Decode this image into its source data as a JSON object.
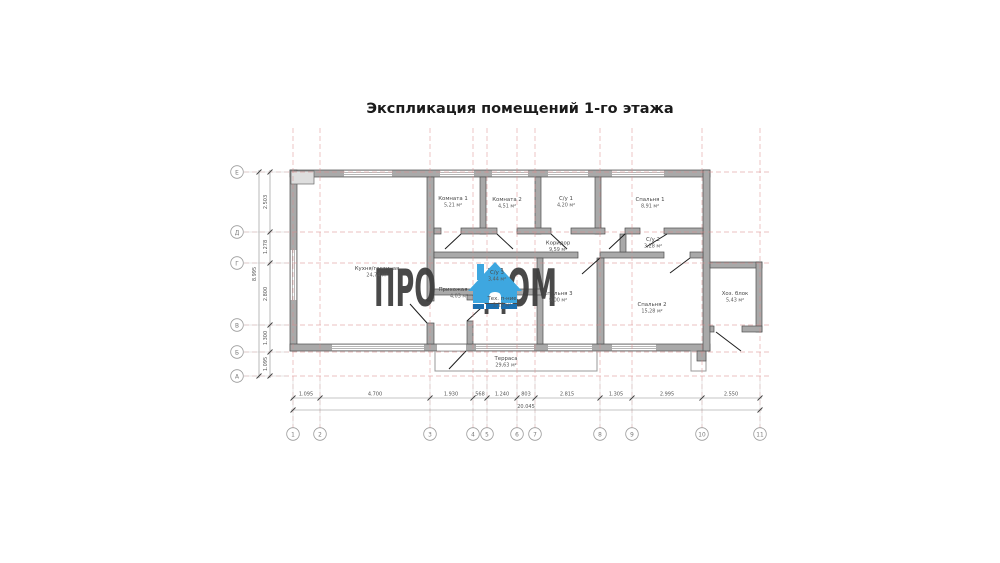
{
  "title": "Экспликация помещений 1-го этажа",
  "watermark": {
    "text_left": "ПРО",
    "text_right": "ДОМ",
    "icon": "house-icon",
    "colors": {
      "text": "#3c3c3c",
      "house_blue": "#3ea7e0",
      "house_dark_blue": "#1b6fb0"
    }
  },
  "colors": {
    "wall_fill": "#a9a9a9",
    "wall_stroke": "#4f4f4f",
    "grid_red": "#d98c8c",
    "dim_gray": "#8a8a8a",
    "label_gray": "#474747"
  },
  "rooms": [
    {
      "name": "Кухня/гостиная",
      "area": "24,74 м²"
    },
    {
      "name": "Комната 1",
      "area": "5,21 м²"
    },
    {
      "name": "Комната 2",
      "area": "4,51 м²"
    },
    {
      "name": "С/у 1",
      "area": "4,20 м²"
    },
    {
      "name": "Спальня 1",
      "area": "8,91 м²"
    },
    {
      "name": "Коридор",
      "area": "9,59 м²"
    },
    {
      "name": "С/у 2",
      "area": "3,28 м²"
    },
    {
      "name": "С/у 3",
      "area": "3,44 м²"
    },
    {
      "name": "Прихожая",
      "area": "4,03 м²"
    },
    {
      "name": "Тех. п-ние",
      "area": "2,18 м²"
    },
    {
      "name": "Спальня 3",
      "area": "9,00 м²"
    },
    {
      "name": "Спальня 2",
      "area": "15,28 м²"
    },
    {
      "name": "Хоз. блок",
      "area": "5,43 м²"
    },
    {
      "name": "Терраса",
      "area": "29,63 м²"
    }
  ],
  "axes": {
    "columns": [
      "1",
      "2",
      "3",
      "4",
      "5",
      "6",
      "7",
      "8",
      "9",
      "10",
      "11"
    ],
    "rows": [
      "Е",
      "Д",
      "Г",
      "В",
      "Б",
      "А"
    ]
  },
  "dimensions": {
    "bottom": [
      "1.095",
      "4.700",
      "1.930",
      "568",
      "1.240",
      "803",
      "2.815",
      "1.305",
      "2.995",
      "2.550"
    ],
    "bottom_total": "20.045",
    "left": [
      "2.503",
      "1.278",
      "2.800",
      "1.300",
      "1.095"
    ],
    "left_total": "8.995"
  }
}
